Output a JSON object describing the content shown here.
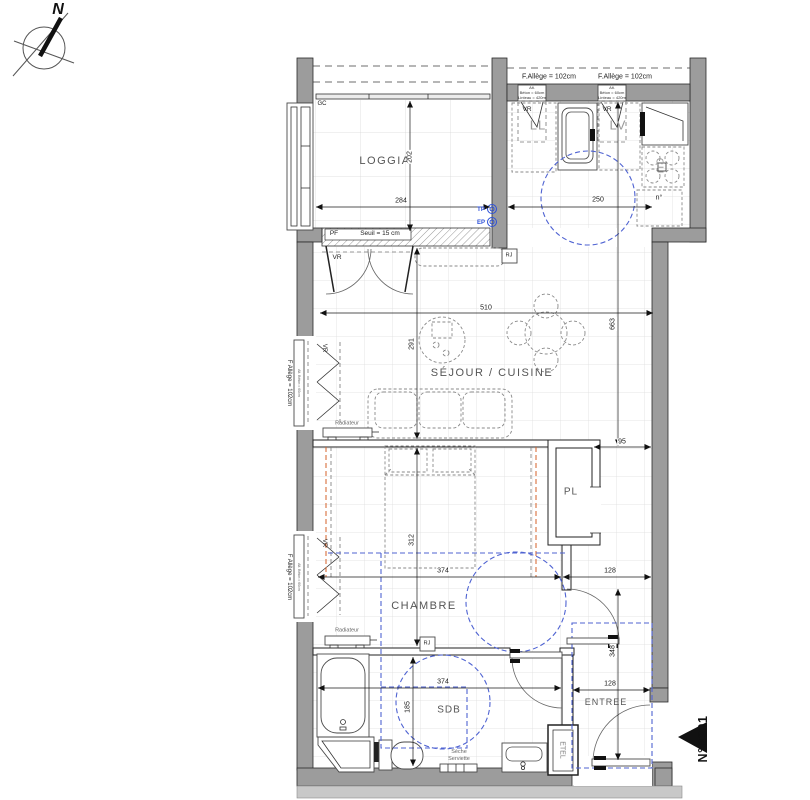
{
  "meta": {
    "accent_blue": "#4f63d2",
    "accent_red": "#d4622a",
    "wall_gray": "#9c9c9c"
  },
  "compass": {
    "north": "N"
  },
  "unit": {
    "number": "N°B301"
  },
  "rooms": {
    "loggia": "LOGGIA",
    "sejour_cuisine": "SÉJOUR / CUISINE",
    "chambre": "CHAMBRE",
    "sdb": "SDB",
    "entree": "ENTREE",
    "placard": "PL",
    "etel": "ETEL"
  },
  "appliances": {
    "lave_linge": "LL",
    "lave_vaisselle": "LV",
    "cuisson": "CU",
    "n_deg": "n°"
  },
  "annotations": {
    "gc": "GC",
    "vr": "VR",
    "pf": "PF",
    "seuil": "Seuil = 15 cm",
    "rj": "RJ",
    "radiateur": "Radiateur",
    "tp": "TP",
    "ep": "EP",
    "seche_line1": "Sèche",
    "seche_line2": "Serviette",
    "f_allege_top": "F.Allège = 102cm",
    "f_allege_side": "F Allège = 102cm",
    "win_note_l1": "Alt.",
    "win_note_l2": "Béton = 60cm",
    "win_note_l3": "Linteau = 420m",
    "win_note_side": "Alt. Béton = 60cm"
  },
  "dimensions": {
    "loggia_width": "284",
    "loggia_depth": "202",
    "cuisine_width": "250",
    "sejour_width": "510",
    "sejour_depth": "291",
    "east_depth": "663",
    "couloir_width": "95",
    "chambre_width": "374",
    "chambre_depth": "312",
    "hall_width_upper": "128",
    "sdb_width": "374",
    "sdb_depth": "185",
    "entree_depth": "348",
    "entree_width": "128"
  }
}
